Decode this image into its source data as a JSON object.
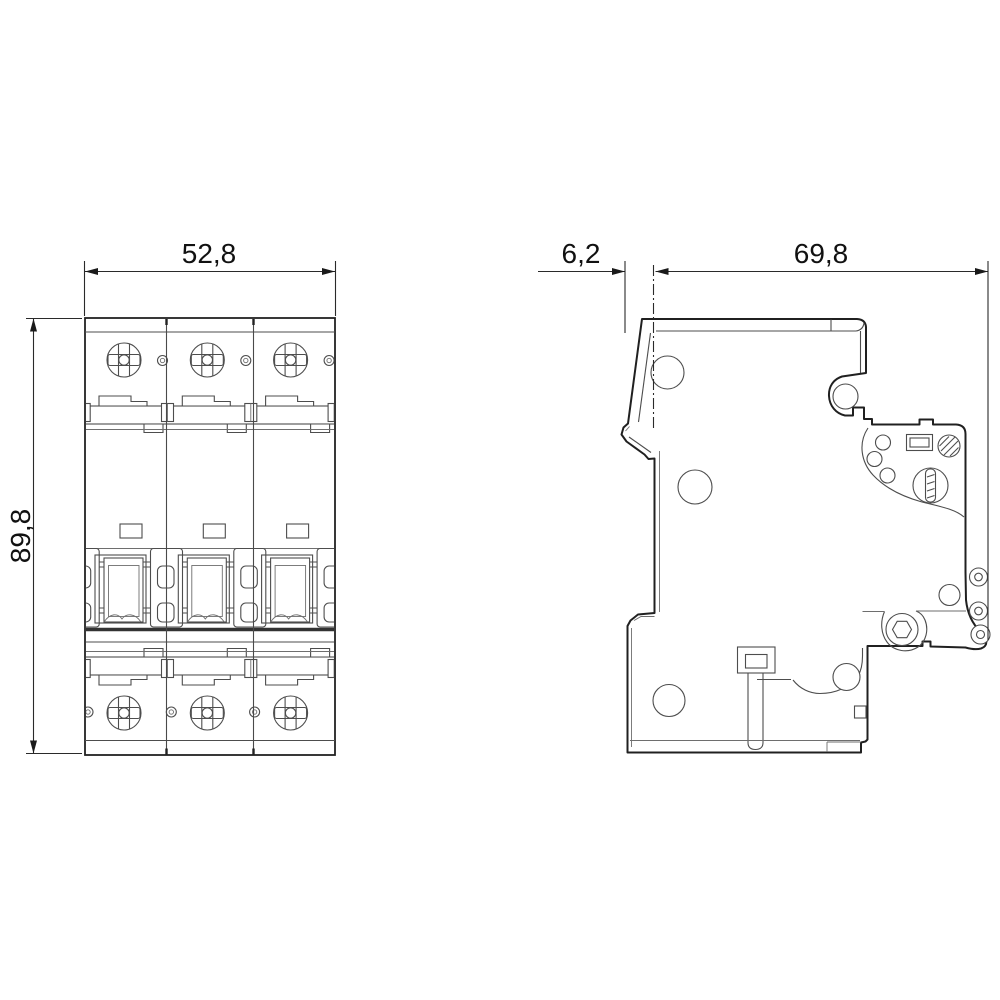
{
  "colors": {
    "background": "#ffffff",
    "outline": "#202020",
    "detail": "#4d4d4d",
    "dimension_line": "#2a2a2a",
    "text": "#111111"
  },
  "front_view": {
    "width_label": "52,8",
    "height_label": "89,8"
  },
  "side_view": {
    "offset_label": "6,2",
    "depth_label": "69,8"
  }
}
